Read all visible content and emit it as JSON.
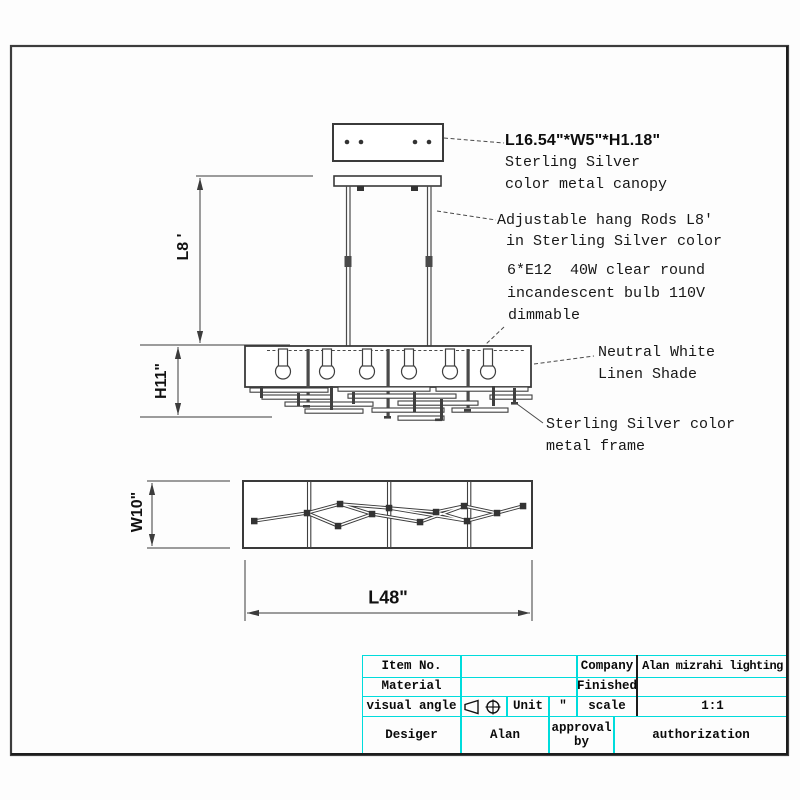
{
  "annotations": {
    "canopy_dims": "L16.54\"*W5\"*H1.18\"",
    "canopy_line2": "Sterling Silver",
    "canopy_line3": "color metal canopy",
    "rods_line1": "Adjustable hang Rods L8'",
    "rods_line2": "in Sterling Silver color",
    "bulb_line1": "6*E12  40W clear round",
    "bulb_line2": "incandescent bulb 110V",
    "bulb_line3": "dimmable",
    "shade_line1": "Neutral White",
    "shade_line2": "Linen Shade",
    "frame_line1": "Sterling Silver color",
    "frame_line2": "metal frame"
  },
  "dimensions": {
    "hang_height": "L8 '",
    "fixture_height": "H11\"",
    "width": "W10\"",
    "length": "L48\""
  },
  "title_block": {
    "item_no_label": "Item No.",
    "item_no_value": "",
    "company_label": "Company",
    "company_value": "Alan mizrahi lighting",
    "material_label": "Material",
    "material_value": "",
    "finished_label": "Finished",
    "finished_value": "",
    "visual_angle_label": "visual angle",
    "unit_label": "Unit",
    "unit_value": "″",
    "scale_label": "scale",
    "scale_value": "1:1",
    "designer_label": "Desiger",
    "designer_value": "Alan",
    "approval_label": "approval\nby",
    "authorization_label": "authorization"
  },
  "colors": {
    "line": "#3c3c3c",
    "table_border": "#00dcdc",
    "text": "#111111"
  }
}
